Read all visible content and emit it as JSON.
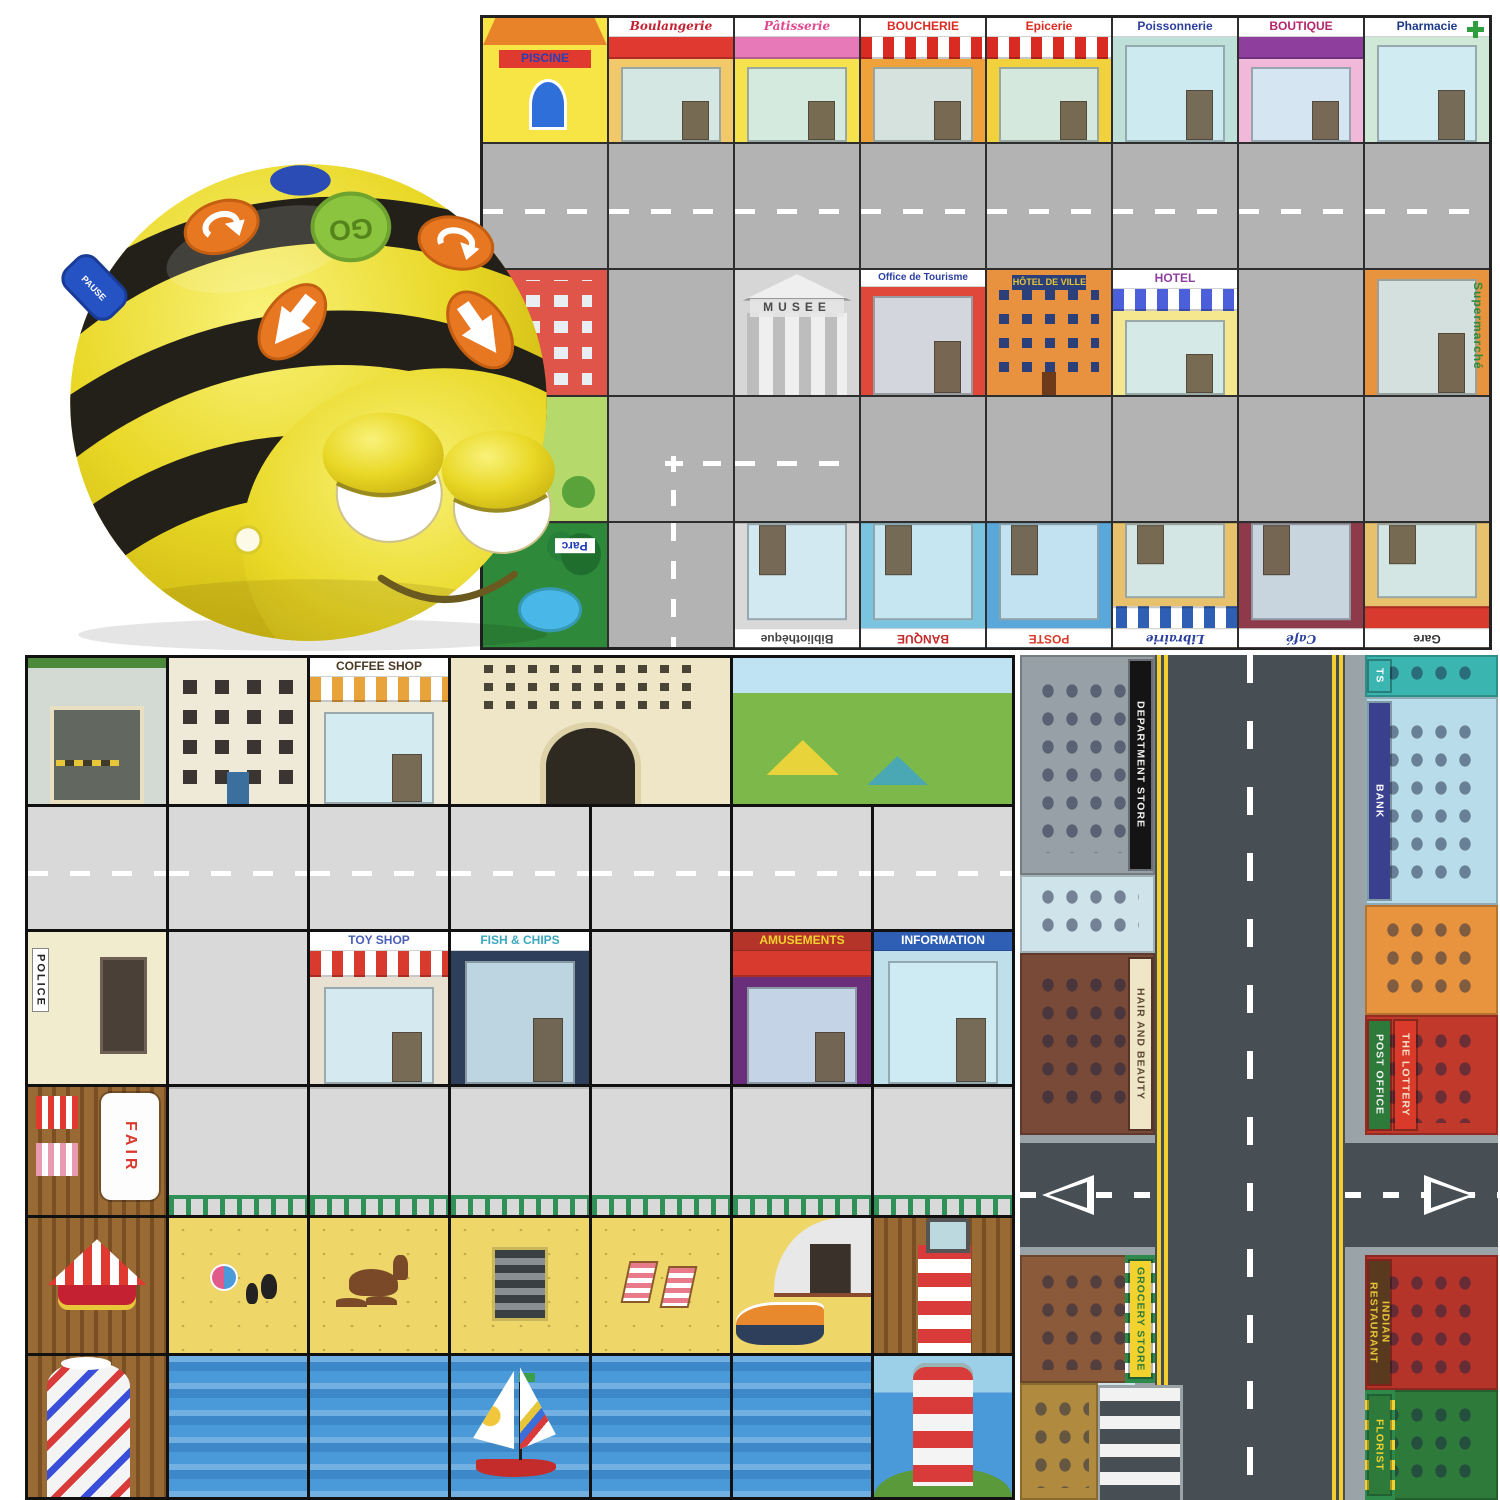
{
  "page": {
    "background": "#ffffff"
  },
  "robot": {
    "name": "Bee-Bot programmable floor robot",
    "body_color": "#e9d826",
    "stripe_color": "#23201a",
    "buttons": {
      "go": "GO",
      "pause": "PAUSE",
      "forward": "forward arrow",
      "backward": "backward arrow",
      "turn_left": "turn left arrow",
      "turn_right": "turn right arrow"
    }
  },
  "mats": {
    "french_town": {
      "name": "French town Bee-Bot mat",
      "grid": {
        "cols": 8,
        "rows": 5
      },
      "rows": [
        [
          {
            "name": "piscine",
            "kind": "piscine",
            "label": "PISCINE",
            "label_color": "#2b3fb5",
            "label_bg": "#e0392f",
            "bg": "#f6e544"
          },
          {
            "name": "boulangerie",
            "kind": "shop",
            "label": "Boulangerie",
            "label_color": "#c42233",
            "script": true,
            "bg": "#f2c96a",
            "awning": [
              "#e0392f"
            ]
          },
          {
            "name": "patisserie",
            "kind": "shop",
            "label": "Pâtisserie",
            "label_color": "#e0488f",
            "script": true,
            "bg": "#f5e24c",
            "awning": [
              "#e879b8"
            ]
          },
          {
            "name": "boucherie",
            "kind": "shop",
            "label": "BOUCHERIE",
            "label_color": "#d92b22",
            "bg": "#f0a23a",
            "awning": [
              "#d92b22",
              "#ffffff"
            ]
          },
          {
            "name": "epicerie",
            "kind": "shop",
            "label": "Epicerie",
            "label_color": "#d92b22",
            "bg": "#f2d23c",
            "awning": [
              "#d92b22",
              "#ffffff"
            ]
          },
          {
            "name": "poissonnerie",
            "kind": "shop",
            "label": "Poissonnerie",
            "label_color": "#2b3f9e",
            "bg": "#bfe0d8"
          },
          {
            "name": "boutique",
            "kind": "shop",
            "label": "BOUTIQUE",
            "label_color": "#b5256d",
            "bg": "#f2b8d9",
            "awning": [
              "#8e3f9e"
            ]
          },
          {
            "name": "pharmacie",
            "kind": "shop",
            "label": "Pharmacie",
            "label_color": "#1d3a8a",
            "bg": "#cfe8d8",
            "cross": true
          }
        ],
        [
          {
            "name": "road",
            "kind": "road-h",
            "bg": "#b3b3b3"
          },
          {
            "name": "road",
            "kind": "road-h",
            "bg": "#b3b3b3"
          },
          {
            "name": "road",
            "kind": "road-h",
            "bg": "#b3b3b3"
          },
          {
            "name": "road",
            "kind": "road-h",
            "bg": "#b3b3b3"
          },
          {
            "name": "road",
            "kind": "road-h",
            "bg": "#b3b3b3"
          },
          {
            "name": "road",
            "kind": "road-h",
            "bg": "#b3b3b3"
          },
          {
            "name": "road",
            "kind": "road-h",
            "bg": "#b3b3b3"
          },
          {
            "name": "road",
            "kind": "road-h",
            "bg": "#b3b3b3"
          }
        ],
        [
          {
            "name": "ecole-building",
            "kind": "building",
            "bg": "#e0554a"
          },
          {
            "name": "road",
            "kind": "road-plain",
            "bg": "#b3b3b3"
          },
          {
            "name": "musee",
            "kind": "classical",
            "label": "MUSEE",
            "label_color": "#4a4a4a",
            "bg": "#d6d6d6"
          },
          {
            "name": "office-de-tourisme",
            "kind": "shop",
            "label": "Office de Tourisme",
            "label_color": "#2b3f9e",
            "bg": "#e0493a"
          },
          {
            "name": "hotel-de-ville",
            "kind": "civic",
            "label": "HÔTEL DE VILLE",
            "label_color": "#e8c63a",
            "label_bg": "#2b3f7a",
            "bg": "#e8913f"
          },
          {
            "name": "hotel",
            "kind": "shop",
            "label": "HOTEL",
            "label_color": "#8e3f9e",
            "bg": "#f5e78e",
            "awning": [
              "#4a5fd9",
              "#ffffff"
            ]
          },
          {
            "name": "road",
            "kind": "road-plain",
            "bg": "#b3b3b3"
          },
          {
            "name": "supermarche",
            "kind": "shop",
            "label": "Supermarché",
            "label_color": "#2e8a3a",
            "vertical": true,
            "bg": "#e8943f"
          }
        ],
        [
          {
            "name": "playground",
            "kind": "park-light",
            "bg": "#b5d96a"
          },
          {
            "name": "road-corner",
            "kind": "road-corner",
            "bg": "#b3b3b3"
          },
          {
            "name": "road",
            "kind": "road-h",
            "bg": "#b3b3b3"
          },
          {
            "name": "road",
            "kind": "road-plain",
            "bg": "#b3b3b3"
          },
          {
            "name": "road",
            "kind": "road-plain",
            "bg": "#b3b3b3"
          },
          {
            "name": "road",
            "kind": "road-plain",
            "bg": "#b3b3b3"
          },
          {
            "name": "road",
            "kind": "road-plain",
            "bg": "#b3b3b3"
          },
          {
            "name": "road",
            "kind": "road-plain",
            "bg": "#b3b3b3"
          }
        ],
        [
          {
            "name": "parc",
            "kind": "park",
            "label": "Parc",
            "label_color": "#1a3bb5",
            "flip": true,
            "bg": "#2e8a3a"
          },
          {
            "name": "road",
            "kind": "road-v",
            "bg": "#b3b3b3"
          },
          {
            "name": "bibliotheque",
            "kind": "shop",
            "label": "Bibliothèque",
            "label_color": "#444444",
            "flip": true,
            "bg": "#d9d9d9"
          },
          {
            "name": "banque",
            "kind": "shop",
            "label": "BANQUE",
            "label_color": "#c42b2b",
            "flip": true,
            "bg": "#7ac4e0"
          },
          {
            "name": "poste",
            "kind": "shop",
            "label": "POSTE",
            "label_color": "#d93a2a",
            "flip": true,
            "bg": "#5aa7d9"
          },
          {
            "name": "librairie",
            "kind": "shop",
            "label": "Librairie",
            "label_color": "#2b3f9e",
            "script": true,
            "flip": true,
            "bg": "#e8c16d",
            "awning": [
              "#2e5fb5",
              "#ffffff"
            ]
          },
          {
            "name": "cafe",
            "kind": "shop",
            "label": "Café",
            "label_color": "#2b3f9e",
            "script": true,
            "flip": true,
            "bg": "#8e3a4a"
          },
          {
            "name": "gare",
            "kind": "shop",
            "label": "Gare",
            "label_color": "#333333",
            "flip": true,
            "bg": "#e8c16d",
            "awning": [
              "#d93a2e"
            ]
          }
        ]
      ]
    },
    "seaside_town": {
      "name": "Seaside town Bee-Bot mat",
      "grid": {
        "cols": 7,
        "rows": 6
      },
      "rows": [
        [
          {
            "name": "car-park",
            "kind": "carpark",
            "bg": "#d3d9d3"
          },
          {
            "name": "flats",
            "kind": "flats",
            "bg": "#efe9d8"
          },
          {
            "name": "coffee-shop",
            "kind": "shop",
            "label": "COFFEE SHOP",
            "label_color": "#4a3a22",
            "bg": "#efe9d8",
            "awning": [
              "#e8a33a",
              "#ffffff"
            ]
          },
          {
            "name": "grand-hotel",
            "kind": "hotel",
            "span": 2,
            "bg": "#efe6c8"
          },
          {
            "name": "campsite",
            "kind": "campsite",
            "span": 2
          }
        ],
        [
          {
            "name": "road",
            "kind": "road-h",
            "bg": "#d9d9d9"
          },
          {
            "name": "road",
            "kind": "road-h",
            "bg": "#d9d9d9"
          },
          {
            "name": "road",
            "kind": "road-h",
            "bg": "#d9d9d9"
          },
          {
            "name": "road",
            "kind": "road-h",
            "bg": "#d9d9d9"
          },
          {
            "name": "road",
            "kind": "road-h",
            "bg": "#d9d9d9"
          },
          {
            "name": "road",
            "kind": "road-h",
            "bg": "#d9d9d9"
          },
          {
            "name": "road",
            "kind": "road-h",
            "bg": "#d9d9d9"
          }
        ],
        [
          {
            "name": "police-station",
            "kind": "police",
            "label": "POLICE",
            "label_color": "#222222",
            "bg": "#f2eccf"
          },
          {
            "name": "pavement",
            "kind": "road-plain",
            "bg": "#d9d9d9"
          },
          {
            "name": "toy-shop",
            "kind": "shop",
            "label": "TOY SHOP",
            "label_color": "#4a5fb5",
            "bg": "#e8e0d0",
            "awning": [
              "#d93a2e",
              "#ffffff"
            ]
          },
          {
            "name": "fish-and-chips",
            "kind": "shop",
            "label": "FISH & CHIPS",
            "label_color": "#3aa8bd",
            "bg": "#2e3f5c"
          },
          {
            "name": "pavement",
            "kind": "road-plain",
            "bg": "#d9d9d9"
          },
          {
            "name": "amusement-arcade",
            "kind": "shop",
            "label": "AMUSEMENTS",
            "label_color": "#f2d22e",
            "label_bg": "#b5342a",
            "bg": "#6a2e7a",
            "awning": [
              "#d93a2e"
            ]
          },
          {
            "name": "tourist-information",
            "kind": "shop",
            "label": "INFORMATION",
            "label_color": "#ffffff",
            "label_bg": "#2e5fb5",
            "bg": "#bfe0ea"
          }
        ],
        [
          {
            "name": "pier-fairground",
            "kind": "pier",
            "banner": "FAIR"
          },
          {
            "name": "promenade",
            "kind": "road-rail",
            "bg": "#d9d9d9"
          },
          {
            "name": "promenade",
            "kind": "road-rail",
            "bg": "#d9d9d9"
          },
          {
            "name": "promenade",
            "kind": "road-rail",
            "bg": "#d9d9d9"
          },
          {
            "name": "promenade",
            "kind": "road-rail",
            "bg": "#d9d9d9"
          },
          {
            "name": "promenade",
            "kind": "road-rail",
            "bg": "#d9d9d9"
          },
          {
            "name": "promenade",
            "kind": "road-rail",
            "bg": "#d9d9d9"
          }
        ],
        [
          {
            "name": "pier-carousel",
            "kind": "carousel"
          },
          {
            "name": "beach-toys",
            "kind": "sand",
            "item": "toys",
            "bg": "#eed768"
          },
          {
            "name": "beach-donkey",
            "kind": "sand",
            "item": "donkey",
            "bg": "#eed768"
          },
          {
            "name": "beach-steps",
            "kind": "sand",
            "item": "steps",
            "bg": "#eed768"
          },
          {
            "name": "beach-deckchairs",
            "kind": "sand",
            "item": "deckchairs",
            "bg": "#eed768"
          },
          {
            "name": "lifeboat-station",
            "kind": "lifeboat",
            "bg": "#eed768"
          },
          {
            "name": "pier-lighthouse-top",
            "kind": "lighthouse-top"
          }
        ],
        [
          {
            "name": "helter-skelter",
            "kind": "helter"
          },
          {
            "name": "sea",
            "kind": "sea"
          },
          {
            "name": "sea",
            "kind": "sea"
          },
          {
            "name": "sailboat",
            "kind": "sailboat"
          },
          {
            "name": "sea",
            "kind": "sea"
          },
          {
            "name": "sea",
            "kind": "sea"
          },
          {
            "name": "lighthouse",
            "kind": "lighthouse"
          }
        ]
      ]
    },
    "road_town": {
      "name": "Town road Bee-Bot mat",
      "road": {
        "surface": "#474f55",
        "edge_line": "#f2cf2e",
        "dash": "#ffffff",
        "sidewalk": "#9aa3a8"
      },
      "left_buildings": [
        {
          "name": "department-store",
          "label": "DEPARTMENT STORE",
          "sign_bg": "#141414",
          "sign_color": "#f2f2f2",
          "bg": "#97a0a6",
          "top": 0,
          "height": 220
        },
        {
          "name": "glass-canopy-shop",
          "bg": "#cfe3ea",
          "top": 220,
          "height": 78
        },
        {
          "name": "hair-and-beauty",
          "label": "HAIR AND BEAUTY",
          "sign_bg": "#efe6c8",
          "sign_color": "#5a4632",
          "bg": "#7a4a38",
          "top": 298,
          "height": 182
        },
        {
          "name": "grocery-store",
          "label": "GROCERY STORE",
          "sign_bg": "#f2d22e",
          "sign_color": "#2e7a3a",
          "bg": "#8a5a3a",
          "awning": [
            "#2e8a4a",
            "#ffffff"
          ],
          "top": 600,
          "height": 128
        },
        {
          "name": "tavern",
          "bg": "#b08a3e",
          "top": 728,
          "height": 117,
          "narrow": true
        }
      ],
      "right_buildings": [
        {
          "name": "sports-shop",
          "label": "TS",
          "sign_bg": "#3ab5b0",
          "sign_color": "#ffffff",
          "bg": "#3ab5b0",
          "top": 0,
          "height": 42
        },
        {
          "name": "bank",
          "label": "BANK",
          "sign_bg": "#3a3f8e",
          "sign_color": "#ffffff",
          "bg": "#b8dcea",
          "top": 42,
          "height": 208
        },
        {
          "name": "town-house",
          "bg": "#e8943f",
          "top": 250,
          "height": 110
        },
        {
          "name": "post-office",
          "label": "POST OFFICE",
          "sign_bg": "#2e7a3a",
          "sign_color": "#f2f2f2",
          "label2": "THE LOTTERY",
          "sign2_bg": "#d93a2a",
          "sign2_color": "#f2e2c8",
          "bg": "#c0392b",
          "top": 360,
          "height": 120
        },
        {
          "name": "indian-restaurant",
          "label": "INDIAN RESTAURANT",
          "sign_bg": "#5a3a1e",
          "sign_color": "#e8c63a",
          "bg": "#b5342a",
          "top": 600,
          "height": 135
        },
        {
          "name": "florist",
          "label": "FLORIST",
          "sign_bg": "#2e7a3a",
          "sign_color": "#f2d22e",
          "bg": "#2e7a3a",
          "awning": [
            "#2e8a4a",
            "#f2d22e"
          ],
          "top": 735,
          "height": 110
        }
      ]
    }
  }
}
